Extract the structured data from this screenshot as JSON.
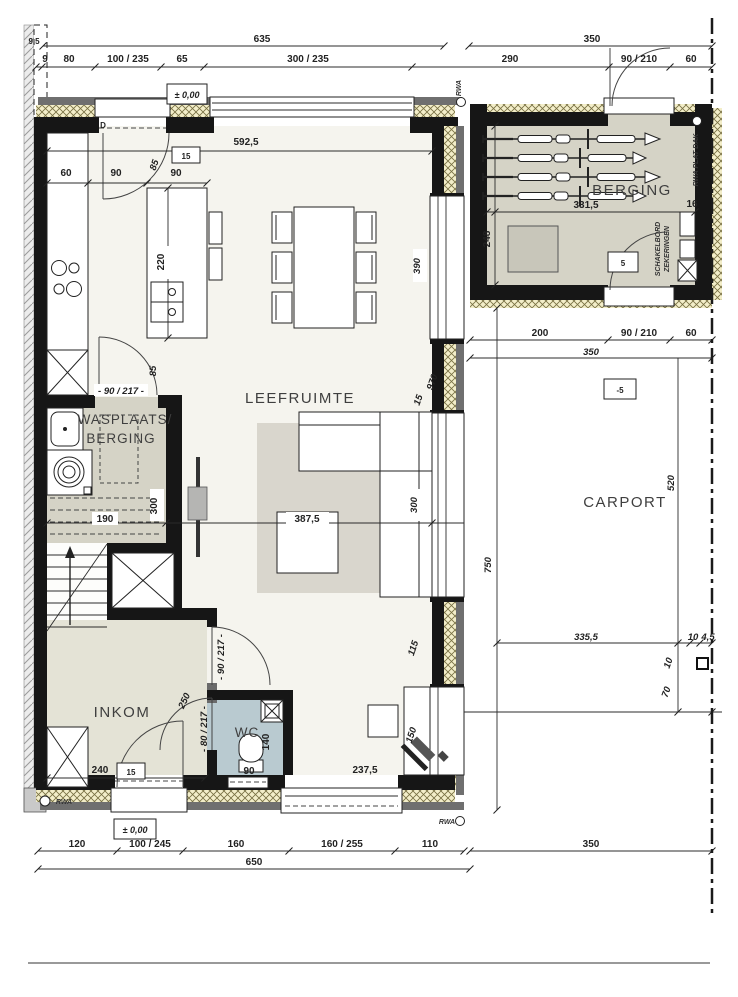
{
  "plan": {
    "rooms": {
      "leefruimte": "LEEFRUIMTE",
      "wasplaats1": "WASPLAATS/",
      "wasplaats2": "BERGING",
      "inkom": "INKOM",
      "wc": "WC",
      "berging": "BERGING",
      "carport": "CARPORT"
    },
    "markers": {
      "level_top": "± 0,00",
      "level_bottom": "± 0,00",
      "carport_level": "-5",
      "berging_step": "5",
      "step15_kitchen": "15",
      "step15_inkom": "15"
    },
    "dims_top": {
      "total_left": "635",
      "total_right": "350",
      "corner": "9,5",
      "s9": "9",
      "s80": "80",
      "s100_235": "100 / 235",
      "s65": "65",
      "s300_235": "300 / 235",
      "s290": "290",
      "s90_210": "90 / 210",
      "s60": "60"
    },
    "dims_bottom": {
      "b120": "120",
      "b100_245": "100 / 245",
      "b160": "160",
      "b160_255": "160 / 255",
      "b110": "110",
      "b650": "650",
      "b350": "350"
    },
    "dims_kitchen": {
      "d592": "592,5",
      "d60": "60",
      "d90a": "90",
      "d90b": "90",
      "d85": "85",
      "d220": "220"
    },
    "dims_living": {
      "d390": "390",
      "d970": "970",
      "d15": "15",
      "d387": "387,5",
      "d300": "300",
      "d115": "115",
      "d150": "150",
      "d237": "237,5"
    },
    "dims_wasplaats": {
      "door": "- 90 / 217 -",
      "d85": "85",
      "d190": "190",
      "d300": "300"
    },
    "dims_inkom": {
      "d240": "240",
      "d250": "250",
      "door90": "- 90 / 217 -",
      "door80": "- 80 / 217 -"
    },
    "dims_wc": {
      "d140": "140",
      "d90": "90"
    },
    "dims_berging": {
      "d331": "331,5",
      "d16": "16",
      "d248": "248"
    },
    "dims_carport": {
      "d200": "200",
      "d90_210": "90 / 210",
      "d60": "60",
      "d350": "350",
      "d520": "520",
      "d750": "750",
      "d335": "335,5",
      "d10a": "10",
      "d45": "4,5",
      "d10b": "10",
      "d70": "70"
    },
    "annotations": {
      "rwa_top": "RWA",
      "rwa_bottom_left": "RWA",
      "rwa_bottom_mid": "RWA",
      "rwa_plat_dak": "RWA PLAT DAK",
      "schakelbord": "SCHAKELBORD",
      "zekeringen": "ZEKERINGEN",
      "door_d": "D"
    }
  }
}
